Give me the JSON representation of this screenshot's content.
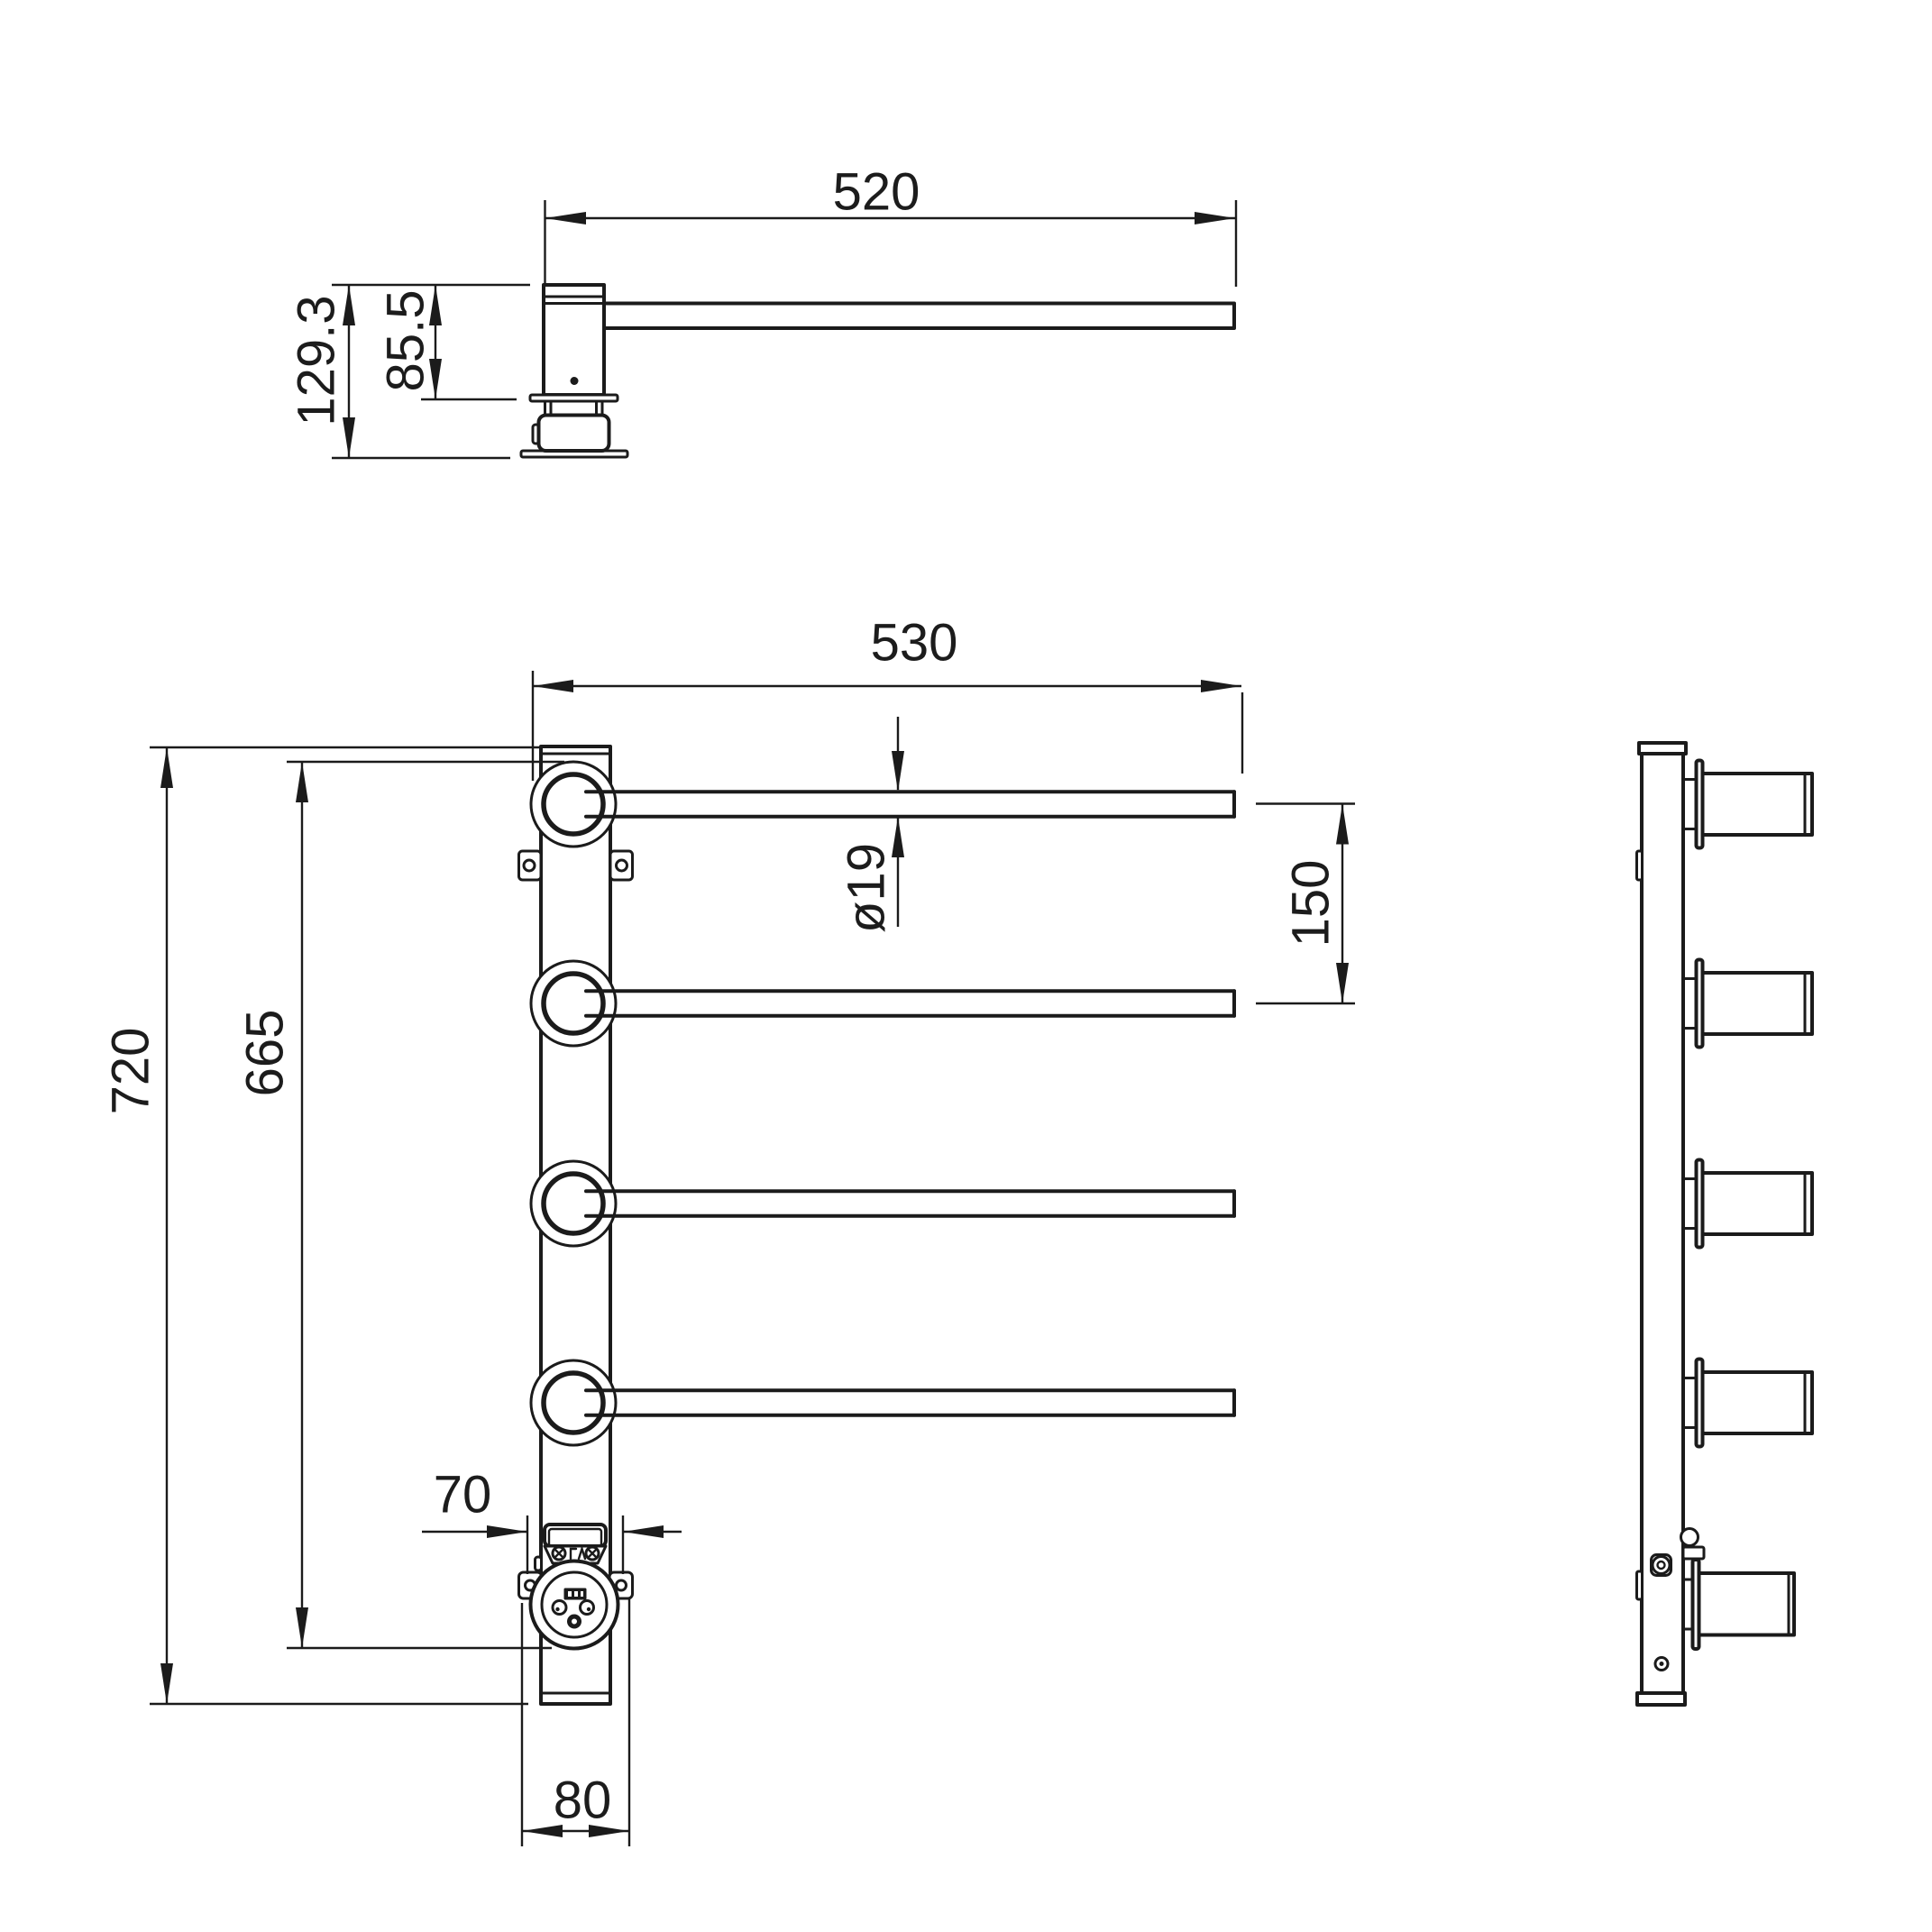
{
  "dimensions": {
    "top": {
      "arm_length": "520",
      "overall_height": "129.3",
      "hub_height": "85.5"
    },
    "front": {
      "overall_width": "530",
      "bar_diameter": "ø19",
      "bar_spacing": "150",
      "overall_height": "720",
      "socket_span": "665",
      "junction_width": "70",
      "base_width": "80"
    }
  }
}
